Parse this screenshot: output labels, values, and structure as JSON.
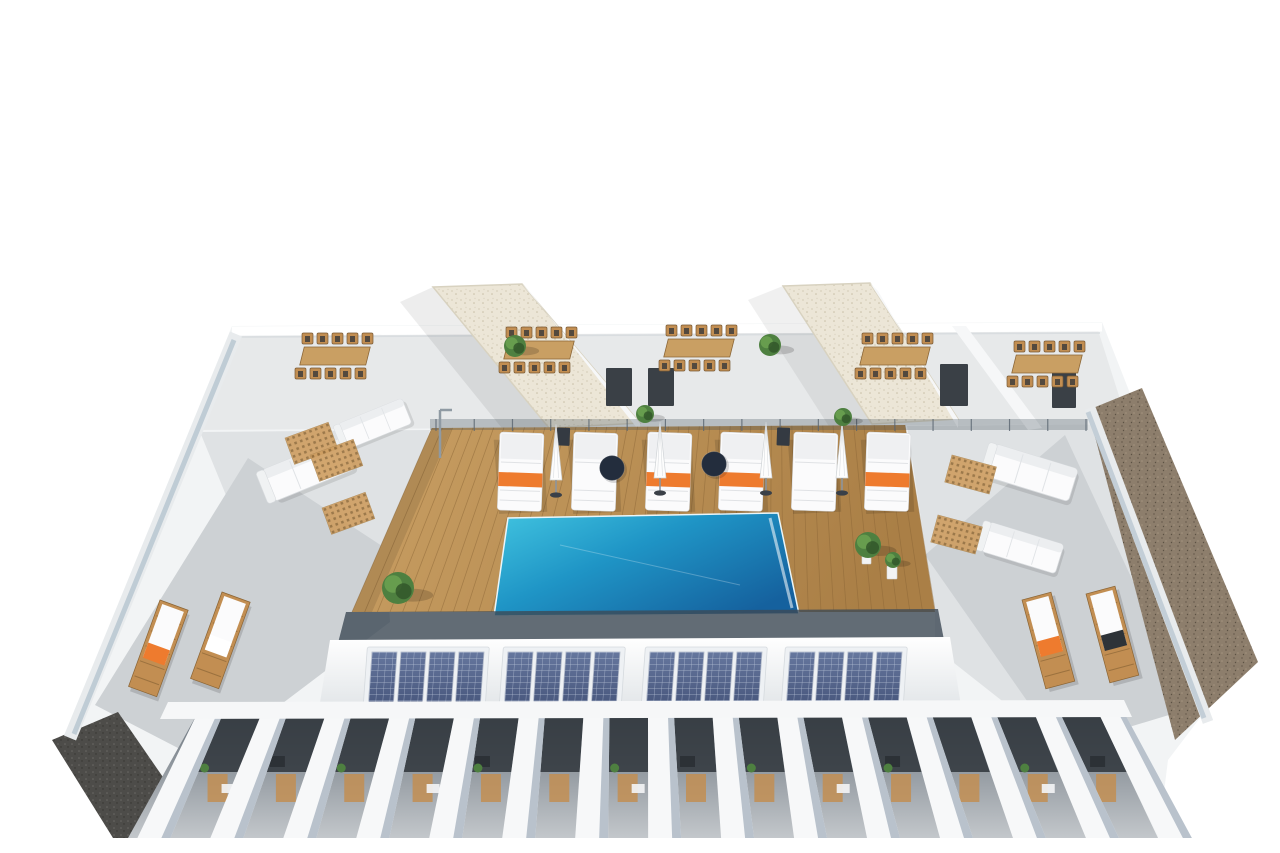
{
  "meta": {
    "kind": "architectural-3d-render",
    "description": "Aerial 3D rendering of an apartment building rooftop: central swimming pool on a wooden deck with six white sun loungers and closed umbrellas, communal dining tables by two gravel-roofed stair towers, four rooftop solar-panel arrays, white pergola beams over private terraces below, and side terraces with wooden loungers."
  },
  "scene": {
    "background": "#ffffff",
    "pool": {
      "label": "swimming-pool",
      "water": "turquoise-to-deep-blue"
    },
    "deck": {
      "label": "wooden-pool-deck",
      "material": "timber planks"
    },
    "pool_loungers": {
      "count": 6,
      "color": "white",
      "orange_towels": 4,
      "closed_umbrellas": 4,
      "round_side_tables": 2
    },
    "dining_areas": {
      "tables": 5,
      "chairs_per_table": 10,
      "material": "light wood"
    },
    "stair_towers": {
      "count": 2,
      "roof": "white gravel"
    },
    "solar_arrays": {
      "count": 4,
      "panels_per_array": 4
    },
    "side_terraces": {
      "left_wood_loungers": 2,
      "right_wood_loungers": 2,
      "towel_colors": [
        "orange",
        "white",
        "orange",
        "black"
      ]
    },
    "lounge_corners": {
      "white_sofas": 4,
      "timber_grate_mats": 5
    },
    "pergola": {
      "white_beams": 15,
      "private_terraces_below": true
    },
    "landscaping": {
      "potted_plants": 7
    },
    "pool_shower": 1,
    "gravel_strips": {
      "right_side": "brown gravel",
      "bottom_left": "dark gravel"
    },
    "glass_railings": true
  },
  "palette": {
    "background": "#ffffff",
    "wall_white": "#f6f7f8",
    "wall_shadow": "#dfe3e6",
    "concrete_light": "#e7e9ea",
    "concrete_mid": "#dfe2e4",
    "concrete_dark": "#cdd1d4",
    "deck_wood_light": "#c99f63",
    "deck_wood_dark": "#aa7f46",
    "deck_line": "#8a6536",
    "pool_light": "#41c4e0",
    "pool_mid": "#1f95c6",
    "pool_deep": "#15619e",
    "glass": "#9fb3c2",
    "railing_dark": "#3d4a55",
    "solar_dark": "#47567c",
    "solar_light": "#66779e",
    "solar_frame": "#eef1f4",
    "lounger_white": "#fbfbfc",
    "towel_orange": "#ee7b2e",
    "towel_black": "#2e3338",
    "wood_furniture": "#c28e52",
    "table_navy": "#232d3d",
    "plant_green": "#4e8040",
    "plant_green_dark": "#33572a",
    "gravel_brown": "#8d7e6c",
    "gravel_dot": "#6e6152",
    "gravel_dark": "#4d4c49",
    "tower_gravel": "#ece6d7",
    "pergola_base_top": "#6d767f",
    "pergola_base_bottom": "#c3c7cb",
    "recess_dark": "#2f353b",
    "beam_white": "#f7f8f9",
    "beam_shade": "#aeb9c4",
    "door_dark": "#3a4046"
  },
  "generate": {
    "deck_planks": {
      "count": 46,
      "top": [
        432,
        428,
        905,
        425
      ],
      "bottom": [
        352,
        612,
        935,
        610
      ]
    },
    "railing_posts": {
      "x1": 436,
      "x2": 1086,
      "y": 419,
      "count": 18
    },
    "pool_loungers": {
      "y": 432,
      "xs": [
        500,
        574,
        648,
        721,
        794,
        867
      ],
      "towel_on": [
        0,
        2,
        3,
        5
      ],
      "side_table_on": [
        1,
        4
      ]
    },
    "umbrellas": [
      [
        556,
        428
      ],
      [
        660,
        426
      ],
      [
        766,
        426
      ],
      [
        842,
        426
      ]
    ],
    "round_tables": [
      [
        612,
        468
      ],
      [
        714,
        464
      ]
    ],
    "dining_sets": [
      [
        336,
        356
      ],
      [
        540,
        350
      ],
      [
        700,
        348
      ],
      [
        896,
        356
      ],
      [
        1048,
        364
      ]
    ],
    "solar": {
      "y": 652,
      "h": 55,
      "w": 112,
      "xs": [
        372,
        508,
        650,
        790
      ],
      "cols": 4
    },
    "pergola": {
      "count": 15,
      "top_y": 716,
      "bottom_y": 838,
      "x_start": 196,
      "x_end": 1100,
      "vanish_x": 647,
      "lean": 0.13,
      "beam_w": 26
    },
    "wood_loungers": [
      {
        "x": 160,
        "y": 600,
        "r": 20,
        "towel": "orange"
      },
      {
        "x": 222,
        "y": 592,
        "r": 20,
        "towel": "white"
      },
      {
        "x": 1022,
        "y": 600,
        "r": -15,
        "towel": "orange"
      },
      {
        "x": 1086,
        "y": 594,
        "r": -15,
        "towel": "black"
      }
    ],
    "grates": [
      [
        285,
        438,
        -20
      ],
      [
        310,
        455,
        -20
      ],
      [
        322,
        508,
        -20
      ],
      [
        952,
        455,
        15
      ],
      [
        938,
        515,
        15
      ]
    ],
    "sofas": [
      [
        262,
        470,
        -22,
        1
      ],
      [
        338,
        424,
        -22,
        0.8
      ],
      [
        996,
        444,
        17,
        1
      ],
      [
        990,
        522,
        17,
        0.9
      ]
    ],
    "plants": [
      [
        398,
        588,
        16
      ],
      [
        868,
        545,
        13
      ],
      [
        645,
        414,
        9
      ],
      [
        843,
        417,
        9
      ],
      [
        515,
        346,
        11
      ],
      [
        770,
        345,
        11
      ],
      [
        893,
        560,
        8
      ]
    ]
  }
}
